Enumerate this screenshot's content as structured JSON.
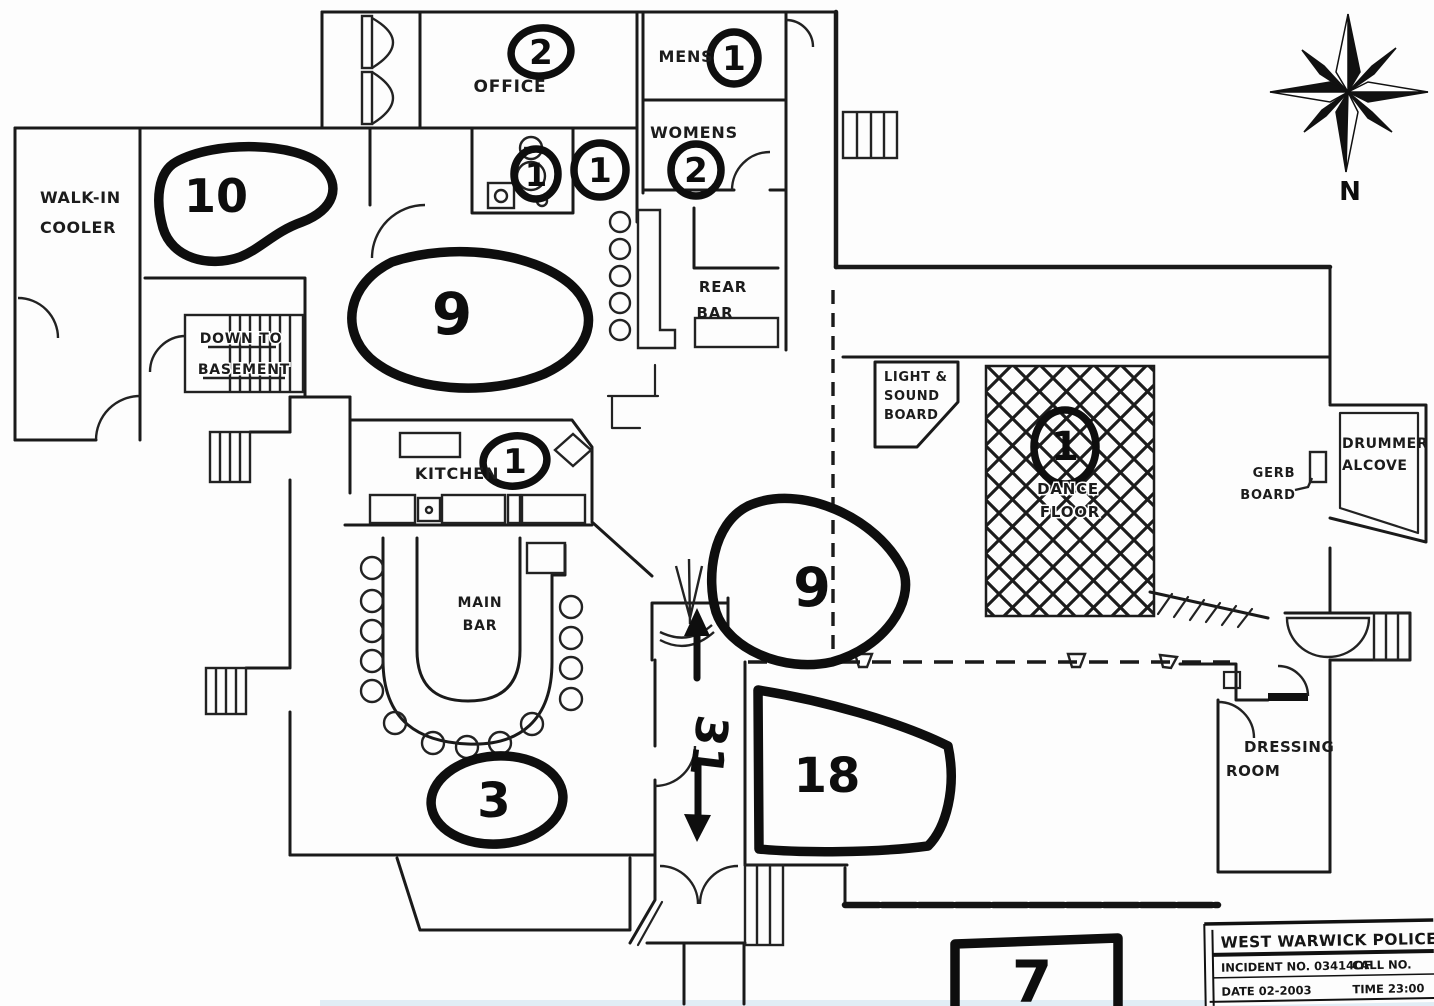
{
  "drawing": {
    "compass_label": "N"
  },
  "rooms": {
    "walk_in_cooler": {
      "line1": "WALK-IN",
      "line2": "COOLER"
    },
    "office": {
      "label": "OFFICE"
    },
    "mens": {
      "label": "MENS"
    },
    "womens": {
      "label": "WOMENS"
    },
    "rear_bar": {
      "line1": "REAR",
      "line2": "BAR"
    },
    "basement_stairs": {
      "line1": "DOWN TO",
      "line2": "BASEMENT"
    },
    "kitchen": {
      "label": "KITCHEN"
    },
    "main_bar": {
      "line1": "MAIN",
      "line2": "BAR"
    },
    "light_sound_board": {
      "line1": "LIGHT &",
      "line2": "SOUND",
      "line3": "BOARD"
    },
    "dance_floor": {
      "line1": "DANCE",
      "line2": "FLOOR"
    },
    "gerb_board": {
      "line1": "GERB",
      "line2": "BOARD"
    },
    "drummer_alcove": {
      "line1": "DRUMMER",
      "line2": "ALCOVE"
    },
    "dressing_room": {
      "line1": "DRESSING",
      "line2": "ROOM"
    }
  },
  "counts": {
    "walk_in_area": "10",
    "prep_area": "9",
    "office": "2",
    "mens": "1",
    "womens": "2",
    "toilet": "1",
    "hallway": "1",
    "kitchen": "1",
    "dance_floor": "1",
    "main_floor_north": "9",
    "corridor": "31",
    "main_floor_south": "18",
    "main_bar": "3",
    "front_lobby": "7"
  },
  "title_block": {
    "agency": "WEST WARWICK POLICE DE",
    "incident": "INCIDENT NO. 03414OF",
    "call": "CALL NO.",
    "date": "DATE 02-2003",
    "time": "TIME 23:00"
  },
  "colors": {
    "ink": "#1a1a1a",
    "paper": "#fdfdfd",
    "scan_edge": "#cfe2f0"
  }
}
